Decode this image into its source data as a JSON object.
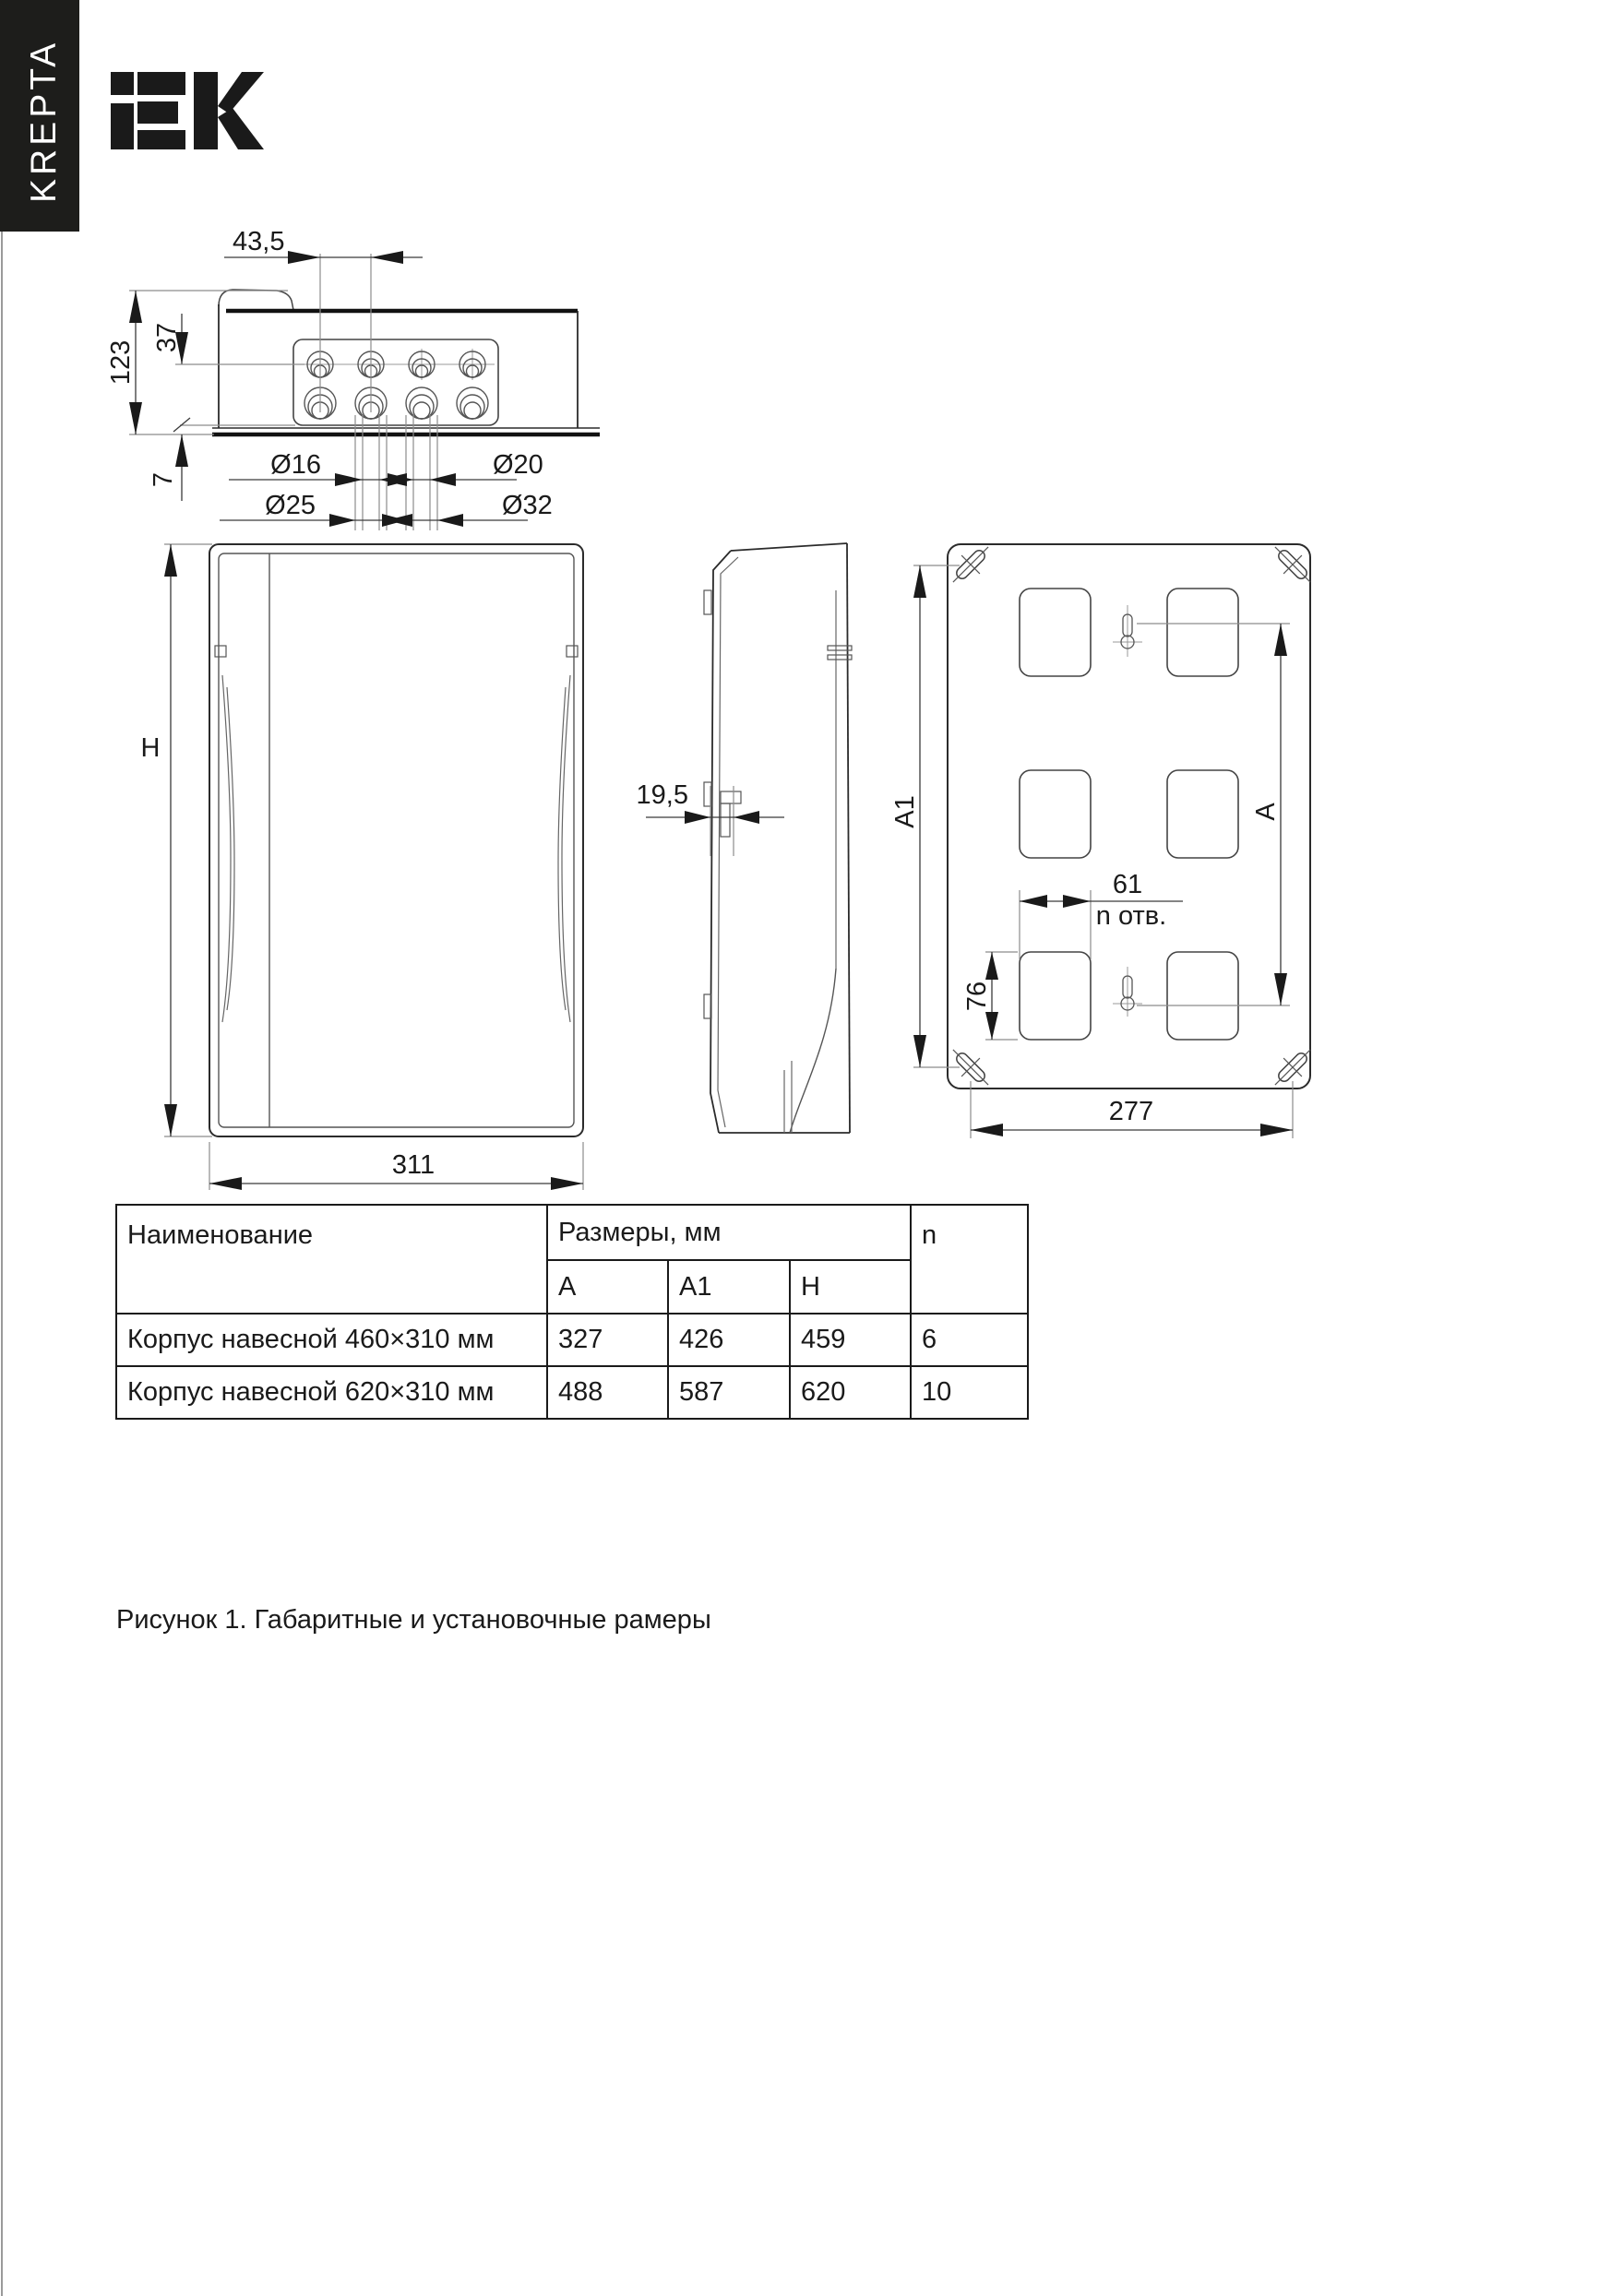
{
  "sidebar": {
    "brand": "KREPTA"
  },
  "logo": {
    "label": "IEK"
  },
  "drawing": {
    "top_view": {
      "pitch": "43,5",
      "depth": "123",
      "top_offset": "37",
      "bottom_offset": "7",
      "dia_small_1": "Ø16",
      "dia_small_2": "Ø20",
      "dia_big_1": "Ø25",
      "dia_big_2": "Ø32"
    },
    "front_view": {
      "height_label": "H",
      "width": "311"
    },
    "side_view": {
      "door_depth": "19,5"
    },
    "back_view": {
      "a1_label": "A1",
      "a_label": "A",
      "hole_pitch": "61",
      "holes_note": "n отв.",
      "hole_height": "76",
      "mount_width": "277"
    }
  },
  "table": {
    "header": {
      "name": "Наименование",
      "sizes": "Размеры, мм",
      "n": "n",
      "col_a": "A",
      "col_a1": "A1",
      "col_h": "H"
    },
    "rows": [
      {
        "name": "Корпус навесной 460×310 мм",
        "a": "327",
        "a1": "426",
        "h": "459",
        "n": "6"
      },
      {
        "name": "Корпус навесной 620×310 мм",
        "a": "488",
        "a1": "587",
        "h": "620",
        "n": "10"
      }
    ]
  },
  "caption": "Рисунок 1. Габаритные и установочные рамеры"
}
